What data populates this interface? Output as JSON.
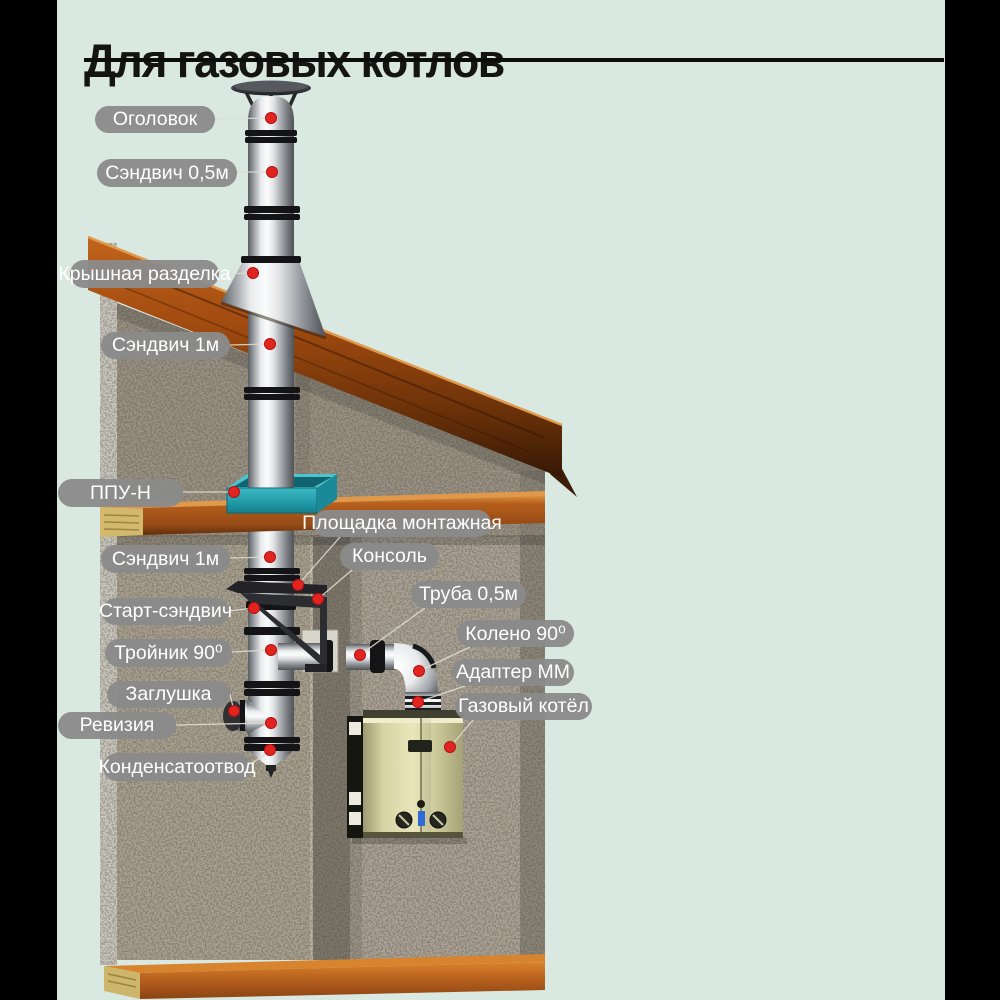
{
  "title": {
    "text": "Для газовых котлов"
  },
  "labels": [
    {
      "id": "ogolovok",
      "text": "Оголовок"
    },
    {
      "id": "sandwich-05",
      "text": "Сэндвич 0,5м"
    },
    {
      "id": "kryshnaya",
      "text": "Крышная разделка"
    },
    {
      "id": "sandwich-1-top",
      "text": "Сэндвич 1м"
    },
    {
      "id": "ppu-n",
      "text": "ППУ-Н"
    },
    {
      "id": "ploshchadka",
      "text": "Площадка монтажная"
    },
    {
      "id": "konsol",
      "text": "Консоль"
    },
    {
      "id": "sandwich-1-low",
      "text": "Сэндвич 1м"
    },
    {
      "id": "truba-05",
      "text": "Труба 0,5м"
    },
    {
      "id": "start-sandwich",
      "text": "Старт-сэндвич"
    },
    {
      "id": "koleno-90",
      "text": "Колено 90⁰"
    },
    {
      "id": "troinik-90",
      "text": "Тройник 90⁰"
    },
    {
      "id": "adapter-mm",
      "text": "Адаптер ММ"
    },
    {
      "id": "zaglushka",
      "text": "Заглушка"
    },
    {
      "id": "gazovy-kotel",
      "text": "Газовый котёл"
    },
    {
      "id": "reviziya",
      "text": "Ревизия"
    },
    {
      "id": "kondensatootvod",
      "text": "Конденсатоотвод"
    }
  ],
  "colors": {
    "background": "#d9e9e1",
    "side_bars": "#000000",
    "title_text": "#141414",
    "label_bg": "#8a8a8a",
    "label_text": "#ffffff",
    "marker_red": "#e31e24",
    "ppu_teal": "#2aa4b2",
    "roof_wood": "#9a4a10",
    "floor_wood": "#b05a17",
    "concrete": "#a29b8e",
    "pipe_steel": "#d9dbdc",
    "boiler_body": "#c9c596"
  }
}
